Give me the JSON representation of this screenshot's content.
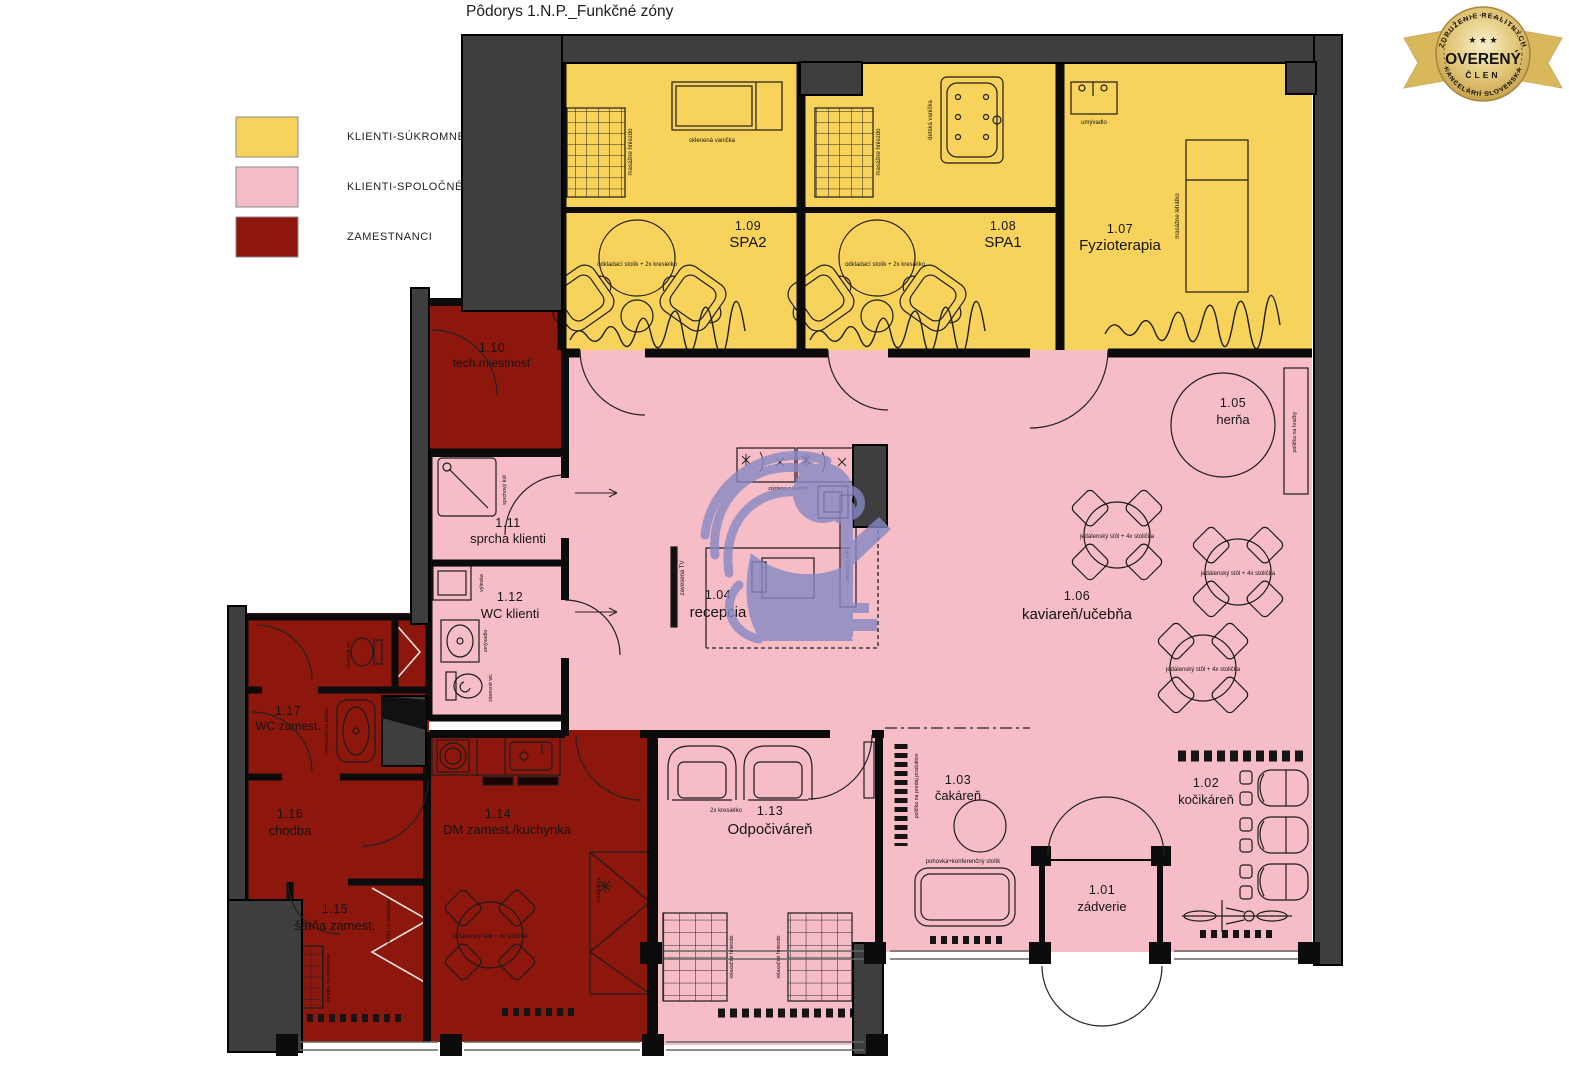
{
  "title": "Pôdorys 1.N.P._Funkčné zóny",
  "legend": {
    "items": [
      {
        "label": "KLIENTI-SÚKROMNÉ",
        "color": "#F8D35C"
      },
      {
        "label": "KLIENTI-SPOLOČNÉ",
        "color": "#F7BDC6"
      },
      {
        "label": "ZAMESTNANCI",
        "color": "#8E170D"
      }
    ]
  },
  "badge": {
    "arc_top": "ZDRUŽENIE REALITNÝCH",
    "arc_bottom": "KANCELÁRIÍ SLOVENSKA",
    "stars": "★ ★ ★",
    "main": "OVERENÝ",
    "sub": "ČLEN",
    "gold": "#D9B85C"
  },
  "colors": {
    "walls": "#3E3E3E",
    "watermark": "#8689C4"
  },
  "rooms": {
    "r101": {
      "id": "1.01",
      "name": "zádverie"
    },
    "r102": {
      "id": "1.02",
      "name": "kočikáreň"
    },
    "r103": {
      "id": "1.03",
      "name": "čakáreň"
    },
    "r104": {
      "id": "1.04",
      "name": "recepcia"
    },
    "r105": {
      "id": "1.05",
      "name": "herňa"
    },
    "r106": {
      "id": "1.06",
      "name": "kaviareň/učebňa"
    },
    "r107": {
      "id": "1.07",
      "name": "Fyzioterapia"
    },
    "r108": {
      "id": "1.08",
      "name": "SPA1"
    },
    "r109": {
      "id": "1.09",
      "name": "SPA2"
    },
    "r110": {
      "id": "1.10",
      "name": "tech.miestnosť"
    },
    "r111": {
      "id": "1.11",
      "name": "sprcha klienti"
    },
    "r112": {
      "id": "1.12",
      "name": "WC klienti"
    },
    "r113": {
      "id": "1.13",
      "name": "Odpočiváreň"
    },
    "r114": {
      "id": "1.14",
      "name": "DM zamest./kuchynka"
    },
    "r115": {
      "id": "1.15",
      "name": "šatňa zamest."
    },
    "r116": {
      "id": "1.16",
      "name": "chodba"
    },
    "r117": {
      "id": "1.17",
      "name": "WC zamest."
    }
  },
  "annotations": {
    "masazne_hniezdo": "masážne hniezdo",
    "sklenena_vanicka": "sklenená vanička",
    "detska_vanicka": "detská vanička",
    "odkladaci_stolik": "odkladací stolík + 2x kresielko",
    "umyvadlo": "umývadlo",
    "masazne_lehatko": "masážne lehátko",
    "sprchovy_kut": "sprchový kút",
    "vylevka": "výlevka",
    "zavesne_wc": "závesné wc",
    "zavesena_tv": "zavesená TV",
    "zastena_s_kvetmi": "zástena s kvetmi",
    "recepcny_pult": "recepčný pult",
    "policka_na_hracky": "polička na hračky",
    "jedalensky_stol": "jedálenský stôl + 4x stolička",
    "dve_kresielka": "2x kresielko",
    "relaxacne_hniezdo": "relaxačné hniezdo",
    "policka_predaj": "polička na predaj produktov",
    "pohovka_stolik": "pohovka+konferenčný stolík",
    "skrinka_na_oblecenie": "skrinka na oblečenie",
    "skrina_na_oblecenie": "skriňa na oblečenie",
    "umyvadlo_na_doske": "umývadlo na doske",
    "chladnicka": "chladnička"
  }
}
